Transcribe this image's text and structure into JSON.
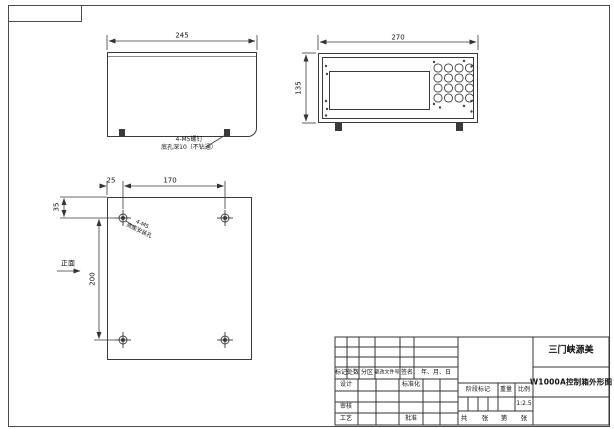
{
  "views": {
    "side": {
      "width_dim": "245",
      "note_line1": "4-M5螺钉",
      "note_line2": "底孔深10（不钻通）"
    },
    "front": {
      "width_dim": "270",
      "height_dim": "135"
    },
    "bottom": {
      "edge_offset_dim": "25",
      "hole_spacing_dim": "170",
      "top_offset_dim": "35",
      "hole_vertical_dim": "200",
      "front_side_label": "正面",
      "hole_note_line1": "4-M5",
      "hole_note_line2": "底座安装孔"
    }
  },
  "title_block": {
    "company": "三门峡源美",
    "drawing_title": "W1000A控制箱外形图",
    "rev_header": [
      "标记",
      "处数",
      "分区",
      "更改文件号",
      "签名",
      "年、月、日"
    ],
    "design": "设计",
    "standardization": "标准化",
    "audit": "审核",
    "process": "工艺",
    "approve": "批准",
    "stage_mark": "阶段标记",
    "weight": "重量",
    "scale": "比例",
    "scale_value": "1:2.5",
    "sheets_total": "共",
    "sheets_unit1": "张",
    "sheets_no": "第",
    "sheets_unit2": "张"
  }
}
